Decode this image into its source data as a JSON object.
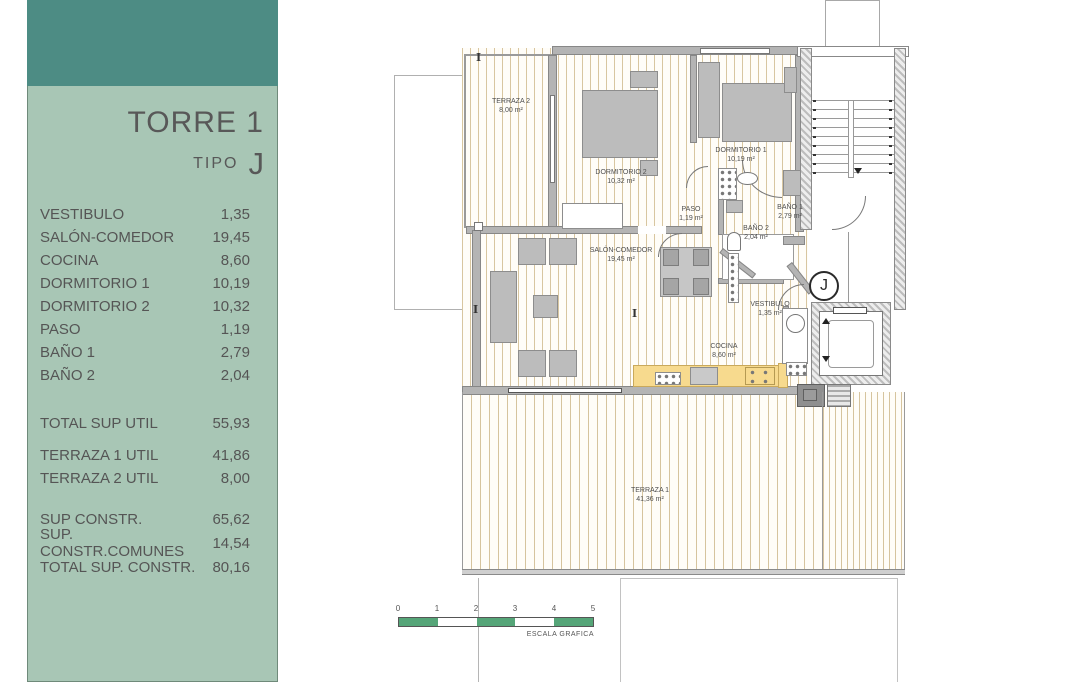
{
  "sidebar": {
    "title": "TORRE 1",
    "tipo_label": "TIPO",
    "tipo_value": "J",
    "rooms": [
      {
        "label": "VESTIBULO",
        "value": "1,35"
      },
      {
        "label": "SALÓN-COMEDOR",
        "value": "19,45"
      },
      {
        "label": "COCINA",
        "value": "8,60"
      },
      {
        "label": "DORMITORIO 1",
        "value": "10,19"
      },
      {
        "label": "DORMITORIO 2",
        "value": "10,32"
      },
      {
        "label": "PASO",
        "value": "1,19"
      },
      {
        "label": "BAÑO 1",
        "value": "2,79"
      },
      {
        "label": "BAÑO 2",
        "value": "2,04"
      }
    ],
    "total_util": {
      "label": "TOTAL SUP UTIL",
      "value": "55,93"
    },
    "terrazas": [
      {
        "label": "TERRAZA 1 UTIL",
        "value": "41,86"
      },
      {
        "label": "TERRAZA 2 UTIL",
        "value": "8,00"
      }
    ],
    "constr": [
      {
        "label": "SUP CONSTR.",
        "value": "65,62"
      },
      {
        "label": "SUP. CONSTR.COMUNES",
        "value": "14,54"
      },
      {
        "label": "TOTAL SUP. CONSTR.",
        "value": "80,16"
      }
    ]
  },
  "plan": {
    "badge": "J",
    "rooms": [
      {
        "name": "TERRAZA 2",
        "area": "8,00 m²"
      },
      {
        "name": "DORMITORIO 2",
        "area": "10,32 m²"
      },
      {
        "name": "DORMITORIO 1",
        "area": "10,19 m²"
      },
      {
        "name": "PASO",
        "area": "1,19 m²"
      },
      {
        "name": "BAÑO 1",
        "area": "2,79 m²"
      },
      {
        "name": "BAÑO 2",
        "area": "2,04 m²"
      },
      {
        "name": "SALÓN-COMEDOR",
        "area": "19,45 m²"
      },
      {
        "name": "VESTIBULO",
        "area": "1,35 m²"
      },
      {
        "name": "COCINA",
        "area": "8,60 m²"
      },
      {
        "name": "TERRAZA 1",
        "area": "41,36 m²"
      }
    ]
  },
  "scale": {
    "ticks": [
      "0",
      "1",
      "2",
      "3",
      "4",
      "5"
    ],
    "label": "ESCALA GRAFICA"
  },
  "colors": {
    "header_teal": "#4d8c84",
    "panel_sage": "#a8c6b5",
    "scale_green": "#55a578",
    "counter_yellow": "#f7da8e",
    "floor_stripe": "#d6c49e"
  }
}
